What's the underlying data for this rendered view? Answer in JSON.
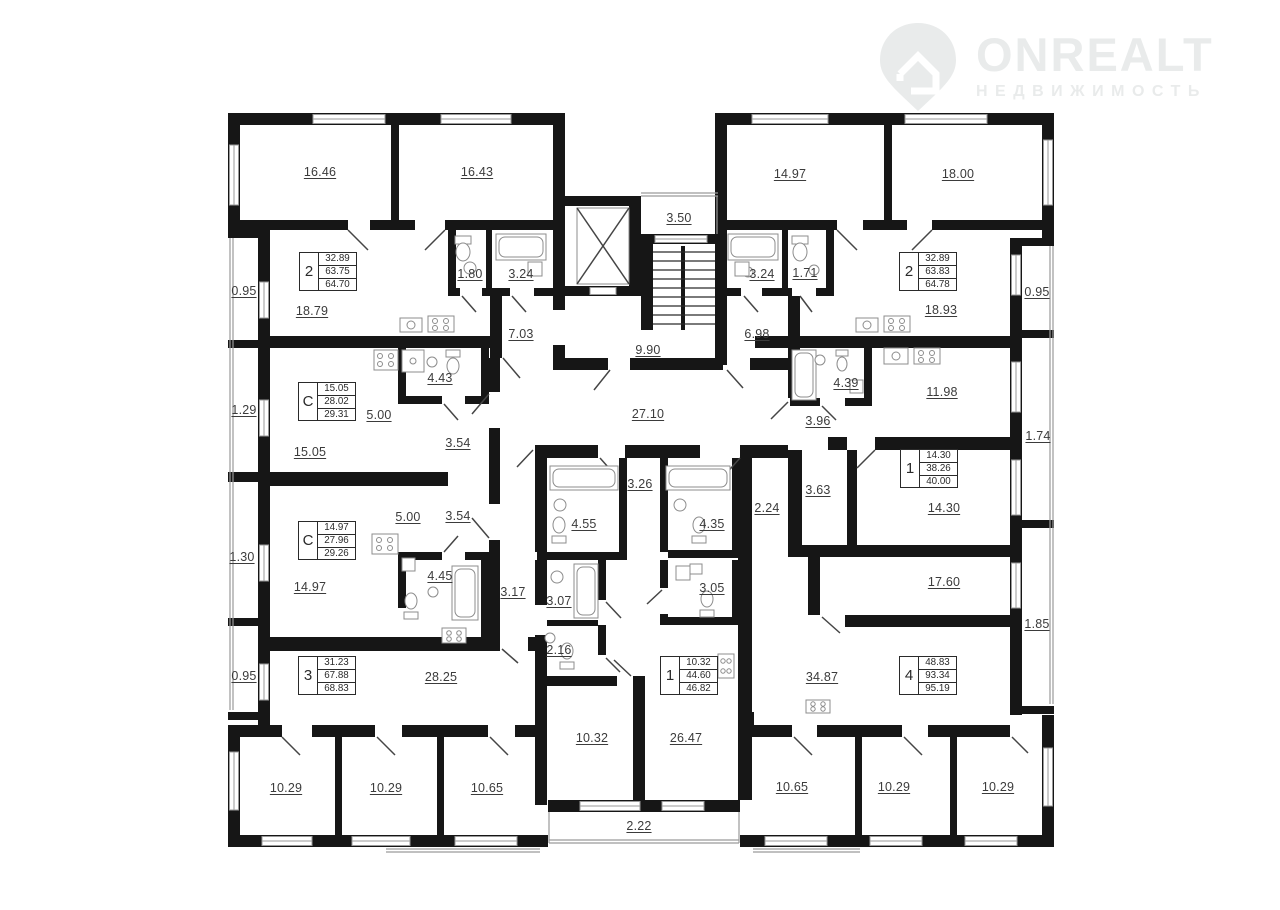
{
  "logo": {
    "brand": "ONREALT",
    "subtitle": "НЕДВИЖИМОСТЬ",
    "color": "#e9ebeb",
    "icon": "house-pin-icon"
  },
  "plan": {
    "colors": {
      "wall": "#161616",
      "label": "#3b3b3b",
      "fixture": "#8c8c8c"
    },
    "apartment_cards": [
      {
        "number": "2",
        "areas": [
          "32.89",
          "63.75",
          "64.70"
        ],
        "x": 299,
        "y": 252
      },
      {
        "number": "2",
        "areas": [
          "32.89",
          "63.83",
          "64.78"
        ],
        "x": 899,
        "y": 252
      },
      {
        "number": "С",
        "areas": [
          "15.05",
          "28.02",
          "29.31"
        ],
        "x": 298,
        "y": 382
      },
      {
        "number": "С",
        "areas": [
          "14.97",
          "27.96",
          "29.26"
        ],
        "x": 298,
        "y": 521
      },
      {
        "number": "1",
        "areas": [
          "14.30",
          "38.26",
          "40.00"
        ],
        "x": 900,
        "y": 449
      },
      {
        "number": "3",
        "areas": [
          "31.23",
          "67.88",
          "68.83"
        ],
        "x": 298,
        "y": 656
      },
      {
        "number": "1",
        "areas": [
          "10.32",
          "44.60",
          "46.82"
        ],
        "x": 660,
        "y": 656
      },
      {
        "number": "4",
        "areas": [
          "48.83",
          "93.34",
          "95.19"
        ],
        "x": 899,
        "y": 656
      }
    ],
    "room_labels": [
      {
        "text": "16.46",
        "x": 320,
        "y": 172
      },
      {
        "text": "16.43",
        "x": 477,
        "y": 172
      },
      {
        "text": "3.50",
        "x": 679,
        "y": 218
      },
      {
        "text": "14.97",
        "x": 790,
        "y": 174
      },
      {
        "text": "18.00",
        "x": 958,
        "y": 174
      },
      {
        "text": "0.95",
        "x": 244,
        "y": 291
      },
      {
        "text": "1.80",
        "x": 470,
        "y": 274
      },
      {
        "text": "3.24",
        "x": 521,
        "y": 274
      },
      {
        "text": "3.24",
        "x": 762,
        "y": 274
      },
      {
        "text": "1.71",
        "x": 805,
        "y": 273
      },
      {
        "text": "0.95",
        "x": 1037,
        "y": 292
      },
      {
        "text": "18.79",
        "x": 312,
        "y": 311
      },
      {
        "text": "7.03",
        "x": 521,
        "y": 334
      },
      {
        "text": "6.98",
        "x": 757,
        "y": 334
      },
      {
        "text": "18.93",
        "x": 941,
        "y": 310
      },
      {
        "text": "9.90",
        "x": 648,
        "y": 350
      },
      {
        "text": "1.29",
        "x": 244,
        "y": 410
      },
      {
        "text": "4.43",
        "x": 440,
        "y": 378
      },
      {
        "text": "5.00",
        "x": 379,
        "y": 415
      },
      {
        "text": "3.54",
        "x": 458,
        "y": 443
      },
      {
        "text": "15.05",
        "x": 310,
        "y": 452
      },
      {
        "text": "27.10",
        "x": 648,
        "y": 414
      },
      {
        "text": "3.96",
        "x": 818,
        "y": 421
      },
      {
        "text": "4.39",
        "x": 846,
        "y": 383
      },
      {
        "text": "11.98",
        "x": 942,
        "y": 392
      },
      {
        "text": "1.74",
        "x": 1038,
        "y": 436
      },
      {
        "text": "3.63",
        "x": 818,
        "y": 490
      },
      {
        "text": "14.30",
        "x": 944,
        "y": 508
      },
      {
        "text": "3.26",
        "x": 640,
        "y": 484
      },
      {
        "text": "4.55",
        "x": 584,
        "y": 524
      },
      {
        "text": "4.35",
        "x": 712,
        "y": 524
      },
      {
        "text": "2.24",
        "x": 767,
        "y": 508
      },
      {
        "text": "5.00",
        "x": 408,
        "y": 517
      },
      {
        "text": "3.54",
        "x": 458,
        "y": 516
      },
      {
        "text": "1.30",
        "x": 242,
        "y": 557
      },
      {
        "text": "14.97",
        "x": 310,
        "y": 587
      },
      {
        "text": "4.45",
        "x": 440,
        "y": 576
      },
      {
        "text": "3.17",
        "x": 513,
        "y": 592
      },
      {
        "text": "3.07",
        "x": 559,
        "y": 601
      },
      {
        "text": "2.16",
        "x": 559,
        "y": 650
      },
      {
        "text": "17.60",
        "x": 944,
        "y": 582
      },
      {
        "text": "1.85",
        "x": 1037,
        "y": 624
      },
      {
        "text": "0.95",
        "x": 244,
        "y": 676
      },
      {
        "text": "28.25",
        "x": 441,
        "y": 677
      },
      {
        "text": "3.05",
        "x": 712,
        "y": 588
      },
      {
        "text": "34.87",
        "x": 822,
        "y": 677
      },
      {
        "text": "10.32",
        "x": 592,
        "y": 738
      },
      {
        "text": "26.47",
        "x": 686,
        "y": 738
      },
      {
        "text": "10.29",
        "x": 286,
        "y": 788
      },
      {
        "text": "10.29",
        "x": 386,
        "y": 788
      },
      {
        "text": "10.65",
        "x": 487,
        "y": 788
      },
      {
        "text": "10.65",
        "x": 792,
        "y": 787
      },
      {
        "text": "10.29",
        "x": 894,
        "y": 787
      },
      {
        "text": "10.29",
        "x": 998,
        "y": 787
      },
      {
        "text": "2.22",
        "x": 639,
        "y": 826
      }
    ]
  }
}
